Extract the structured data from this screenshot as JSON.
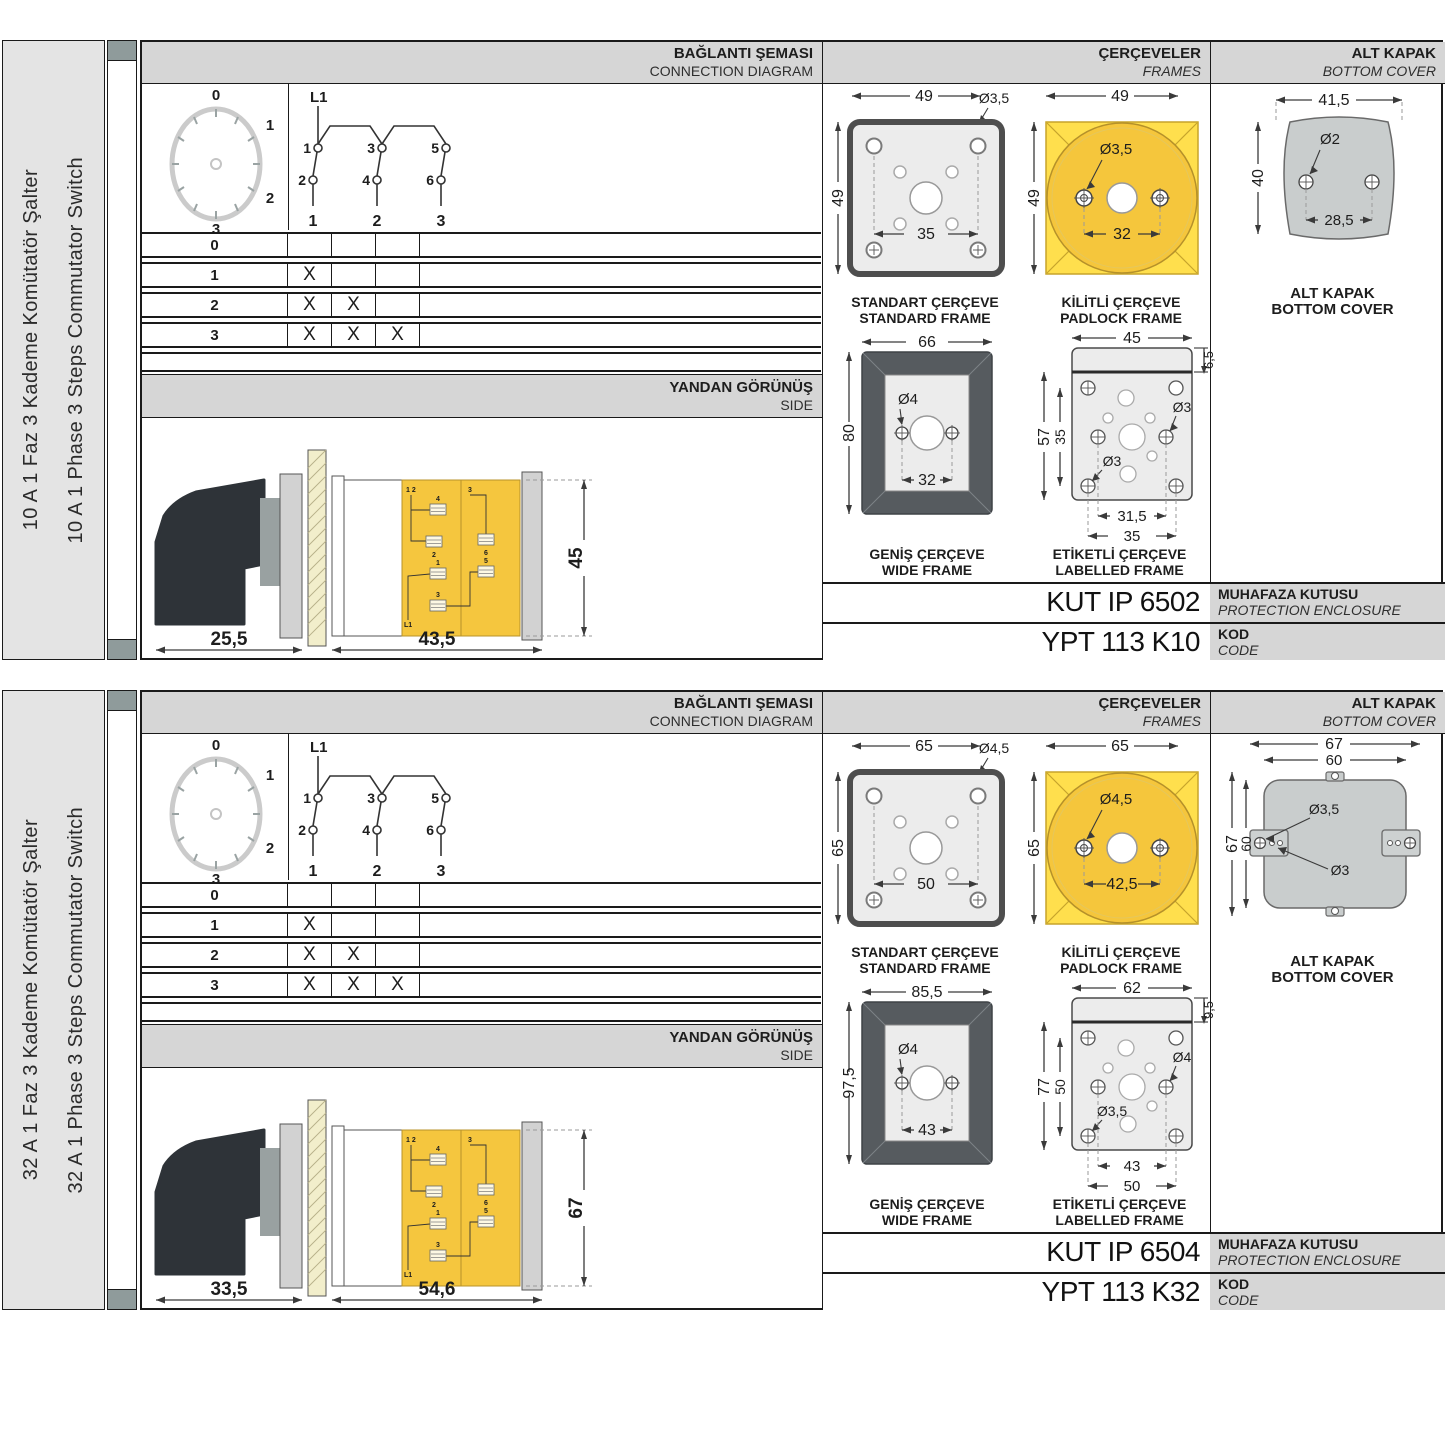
{
  "colors": {
    "accent_yellow": "#FFDF4D",
    "accent_yellow_dark": "#F5C63C",
    "header_gray": "#D6D6D6",
    "frame_dark": "#565B5F",
    "cover_gray": "#C9CDCD",
    "tab_gray": "#8F9B9B"
  },
  "sections": [
    {
      "amp_tr": "10 A 1 Faz 3 Kademe Komütatör Şalter",
      "amp_en": "10 A 1 Phase 3 Steps Commutator Switch",
      "connection": {
        "title_tr": "BAĞLANTI ŞEMASI",
        "title_en": "CONNECTION DIAGRAM",
        "dial": {
          "p0": "0",
          "p1": "1",
          "p2": "2",
          "p3": "3"
        },
        "circuit": {
          "source": "L1",
          "c1": "1",
          "c2": "2",
          "c3": "3",
          "c4": "4",
          "c5": "5",
          "c6": "6",
          "o1": "1",
          "o2": "2",
          "o3": "3"
        },
        "table": {
          "rows": [
            {
              "pos": "0",
              "m": [
                "",
                "",
                ""
              ]
            },
            {
              "pos": "1",
              "m": [
                "X",
                "",
                ""
              ]
            },
            {
              "pos": "2",
              "m": [
                "X",
                "X",
                ""
              ]
            },
            {
              "pos": "3",
              "m": [
                "X",
                "X",
                "X"
              ]
            }
          ]
        }
      },
      "side": {
        "title_tr": "YANDAN GÖRÜNÜŞ",
        "title_en": "SIDE",
        "d_handle": "25,5",
        "d_body": "43,5",
        "d_height": "45",
        "t_top": "1 2",
        "t4": "4",
        "t2": "2",
        "t3": "3",
        "t6": "6",
        "t1": "1",
        "t5": "5",
        "t3b": "3",
        "src": "L1"
      },
      "frames": {
        "title_tr": "ÇERÇEVELER",
        "title_en": "FRAMES",
        "std": {
          "w": "49",
          "h": "49",
          "hole": "Ø3,5",
          "inner": "35",
          "cap_tr": "STANDART ÇERÇEVE",
          "cap_en": "STANDARD FRAME"
        },
        "pad": {
          "w": "49",
          "h": "49",
          "hole": "Ø3,5",
          "inner": "32",
          "cap_tr": "KİLİTLİ ÇERÇEVE",
          "cap_en": "PADLOCK FRAME"
        },
        "wide": {
          "w": "66",
          "h": "80",
          "hole": "Ø4",
          "inner": "32",
          "cap_tr": "GENİŞ ÇERÇEVE",
          "cap_en": "WIDE FRAME"
        },
        "lab": {
          "w": "45",
          "strip": "6,5",
          "h": "57",
          "hin": "35",
          "hole_r": "Ø3",
          "hole_l": "Ø3",
          "win": "31,5",
          "wout": "35",
          "cap_tr": "ETİKETLİ ÇERÇEVE",
          "cap_en": "LABELLED FRAME"
        }
      },
      "cover": {
        "title_tr": "ALT KAPAK",
        "title_en": "BOTTOM COVER",
        "cap_tr": "ALT KAPAK",
        "cap_en": "BOTTOM COVER",
        "w": "41,5",
        "hole": "Ø2",
        "h": "40",
        "inner": "28,5"
      },
      "codes": {
        "enclosure": "KUT IP 6502",
        "enc_tr": "MUHAFAZA KUTUSU",
        "enc_en": "PROTECTION ENCLOSURE",
        "code": "YPT 113 K10",
        "code_tr": "KOD",
        "code_en": "CODE"
      }
    },
    {
      "amp_tr": "32 A 1 Faz 3 Kademe Komütatör Şalter",
      "amp_en": "32 A 1 Phase 3 Steps Commutator Switch",
      "connection": {
        "title_tr": "BAĞLANTI ŞEMASI",
        "title_en": "CONNECTION DIAGRAM",
        "dial": {
          "p0": "0",
          "p1": "1",
          "p2": "2",
          "p3": "3"
        },
        "circuit": {
          "source": "L1",
          "c1": "1",
          "c2": "2",
          "c3": "3",
          "c4": "4",
          "c5": "5",
          "c6": "6",
          "o1": "1",
          "o2": "2",
          "o3": "3"
        },
        "table": {
          "rows": [
            {
              "pos": "0",
              "m": [
                "",
                "",
                ""
              ]
            },
            {
              "pos": "1",
              "m": [
                "X",
                "",
                ""
              ]
            },
            {
              "pos": "2",
              "m": [
                "X",
                "X",
                ""
              ]
            },
            {
              "pos": "3",
              "m": [
                "X",
                "X",
                "X"
              ]
            }
          ]
        }
      },
      "side": {
        "title_tr": "YANDAN GÖRÜNÜŞ",
        "title_en": "SIDE",
        "d_handle": "33,5",
        "d_body": "54,6",
        "d_height": "67",
        "t_top": "1 2",
        "t4": "4",
        "t2": "2",
        "t3": "3",
        "t6": "6",
        "t1": "1",
        "t5": "5",
        "t3b": "3",
        "src": "L1"
      },
      "frames": {
        "title_tr": "ÇERÇEVELER",
        "title_en": "FRAMES",
        "std": {
          "w": "65",
          "h": "65",
          "hole": "Ø4,5",
          "inner": "50",
          "cap_tr": "STANDART ÇERÇEVE",
          "cap_en": "STANDARD FRAME"
        },
        "pad": {
          "w": "65",
          "h": "65",
          "hole": "Ø4,5",
          "inner": "42,5",
          "cap_tr": "KİLİTLİ ÇERÇEVE",
          "cap_en": "PADLOCK FRAME"
        },
        "wide": {
          "w": "85,5",
          "h": "97,5",
          "hole": "Ø4",
          "inner": "43",
          "cap_tr": "GENİŞ ÇERÇEVE",
          "cap_en": "WIDE FRAME"
        },
        "lab": {
          "w": "62",
          "strip": "9,5",
          "h": "77",
          "hin": "50",
          "hole_r": "Ø4",
          "hole_l": "Ø3,5",
          "win": "43",
          "wout": "50",
          "cap_tr": "ETİKETLİ ÇERÇEVE",
          "cap_en": "LABELLED FRAME"
        }
      },
      "cover": {
        "title_tr": "ALT KAPAK",
        "title_en": "BOTTOM COVER",
        "cap_tr": "ALT KAPAK",
        "cap_en": "BOTTOM COVER",
        "w_out": "67",
        "w_in": "60",
        "h_out": "67",
        "h_in": "60",
        "hole_top": "Ø3,5",
        "hole_mid": "Ø3"
      },
      "codes": {
        "enclosure": "KUT IP 6504",
        "enc_tr": "MUHAFAZA KUTUSU",
        "enc_en": "PROTECTION ENCLOSURE",
        "code": "YPT 113 K32",
        "code_tr": "KOD",
        "code_en": "CODE"
      }
    }
  ]
}
